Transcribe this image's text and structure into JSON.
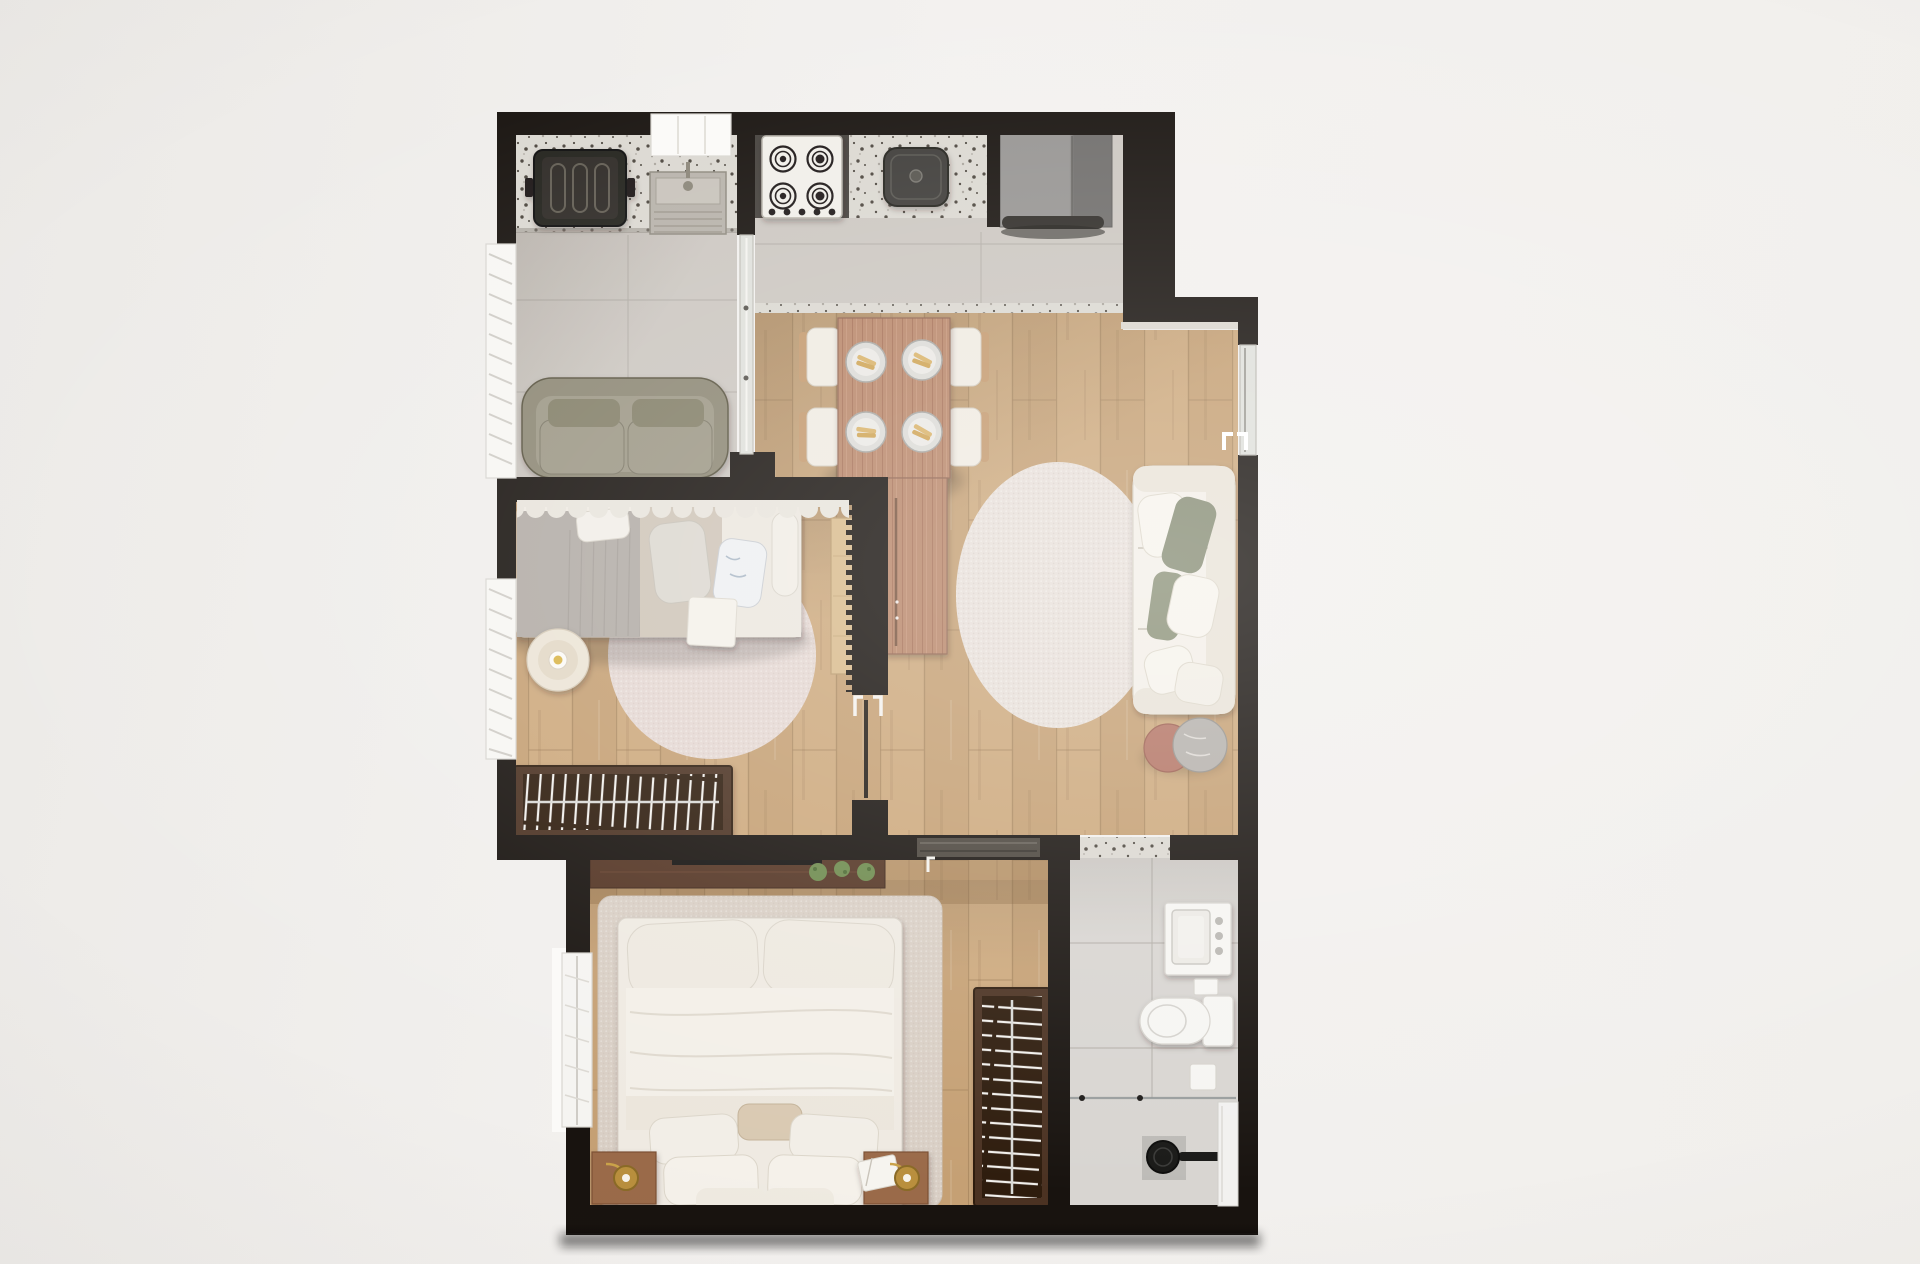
{
  "canvas": {
    "width": 1920,
    "height": 1264
  },
  "colors": {
    "bg": "#f1efec",
    "wall": "#18130f",
    "tile": "#ccc7c1",
    "tileSeam": "#b3aea8",
    "granite": "#dbd8d1",
    "graniteSpeck": "#4b453d",
    "wood": "#cda97d",
    "wood2": "#c5a074",
    "woodSeam": "#a8865e",
    "woodDarkOverlay": "#7a5530",
    "bath": "#d8d5d1",
    "bathSeam": "#c2bfba",
    "fixture": "#f6f5f2",
    "fixtureStroke": "#d6d3cd",
    "rugLiving": "#e8e0da",
    "rugBed1": "#e5d8d3",
    "rugBed2": "#d9cfc5",
    "sofaWhite": "#f3efe8",
    "sofaShade": "#e9e3d8",
    "olive": "#8d8875",
    "oliveCushion": "#9d9886",
    "olivePillow": "#848069",
    "tableWood": "#b9876b",
    "tableGrain": "#9c6750",
    "chairSeat": "#f0ebe2",
    "chairBack": "#c49a6f",
    "rackFrame": "#4c3120",
    "rackInner": "#2f1d10",
    "hanger": "#f2f0ec",
    "rail": "#d9d9d6",
    "bedWhite": "#efeae2",
    "blanket": "#b2aca6",
    "sheet": "#cfc5b8",
    "curtain": "#e8e4dc",
    "nightstand": "#9a6a48",
    "lampGold": "#c29a43",
    "shelf": "#543524",
    "plant": "#6d8a4d",
    "fridge1": "#969492",
    "fridge2": "#6f6d6b",
    "stove": "#f1efe9",
    "burner": "#1b1916",
    "basin": "#3c3a37",
    "glass": "#dfe0db",
    "marble": "#b5b1ac",
    "terracotta": "#b47565",
    "towel": "#f4f1ea"
  },
  "scene": {
    "rooms": [
      {
        "name": "service-area",
        "items": [
          "laundry-tank",
          "utility-sink",
          "granite-counter",
          "olive-loveseat",
          "louver-window",
          "glass-partition"
        ]
      },
      {
        "name": "kitchen",
        "items": [
          "cooktop",
          "kitchen-basin",
          "granite-counter",
          "refrigerator",
          "window-sill"
        ]
      },
      {
        "name": "dining-area",
        "items": [
          "dining-table",
          "console-extension",
          "chairs",
          "place-settings",
          "granite-threshold"
        ]
      },
      {
        "name": "living-room",
        "items": [
          "white-sofa",
          "round-rug",
          "marble-side-table",
          "terracotta-side-table",
          "balcony-door"
        ]
      },
      {
        "name": "bedroom-1",
        "items": [
          "single-bed",
          "curtain-valance",
          "round-rug",
          "round-side-table",
          "clothes-rack",
          "wardrobe",
          "door",
          "louver-window"
        ]
      },
      {
        "name": "bedroom-2",
        "items": [
          "double-bed",
          "area-rug",
          "nightstands",
          "table-lamps",
          "headboard-shelf",
          "plants",
          "clothes-rack",
          "balcony-window",
          "sliding-door"
        ]
      },
      {
        "name": "bathroom",
        "items": [
          "vanity-sink",
          "toilet",
          "paper-box",
          "shower-head",
          "shower-glass",
          "wall-niche"
        ]
      }
    ]
  }
}
